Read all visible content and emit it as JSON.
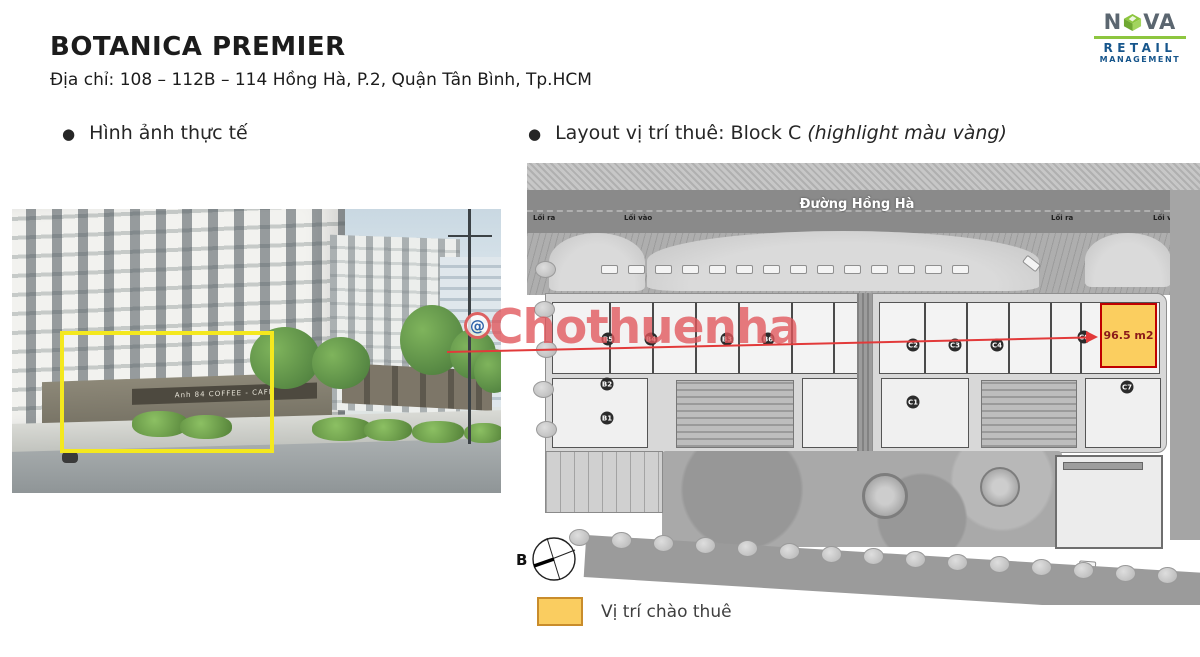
{
  "header": {
    "title": "BOTANICA PREMIER",
    "address": "Địa chỉ: 108 – 112B – 114 Hồng Hà, P.2, Quận Tân Bình, Tp.HCM"
  },
  "logo": {
    "name_left": "N",
    "name_right": "VA",
    "line1": "RETAIL",
    "line2": "MANAGEMENT",
    "green": "#8DC63F",
    "blue": "#17568C"
  },
  "sections": {
    "photo_heading": "Hình ảnh thực tế",
    "layout_heading": "Layout vị trí thuê: Block C ",
    "layout_heading_italic": "(highlight màu vàng)"
  },
  "photo": {
    "sign_text": "Anh 84 COFFEE - CAFE",
    "highlight_color": "#F4E81E"
  },
  "watermark": {
    "text": "Chothuenha",
    "icon": "@",
    "color": "#E0555A"
  },
  "plan": {
    "street_name": "Đường Hồng Hà",
    "road_labels": [
      {
        "text": "Lối ra",
        "x": 6
      },
      {
        "text": "Lối vào",
        "x": 97
      },
      {
        "text": "Lối ra",
        "x": 524
      },
      {
        "text": "Lối vào",
        "x": 626
      }
    ],
    "units": [
      {
        "label": "B5",
        "x": 81,
        "y": 176
      },
      {
        "label": "B4",
        "x": 124,
        "y": 176
      },
      {
        "label": "B3",
        "x": 200,
        "y": 176
      },
      {
        "label": "B6",
        "x": 241,
        "y": 176
      },
      {
        "label": "B2",
        "x": 80,
        "y": 221
      },
      {
        "label": "B1",
        "x": 80,
        "y": 255
      },
      {
        "label": "C2",
        "x": 386,
        "y": 182
      },
      {
        "label": "C3",
        "x": 428,
        "y": 182
      },
      {
        "label": "C4",
        "x": 470,
        "y": 182
      },
      {
        "label": "C1",
        "x": 386,
        "y": 239
      },
      {
        "label": "C6",
        "x": 557,
        "y": 174
      },
      {
        "label": "C7",
        "x": 600,
        "y": 224
      },
      {
        "label": "C8",
        "x": 571,
        "y": 348
      }
    ],
    "highlight_unit": {
      "area_label": "96.5 m2",
      "x": 573,
      "y": 140,
      "w": 57,
      "h": 65
    },
    "compass_label": "B"
  },
  "legend": {
    "label": "Vị trí chào thuê",
    "swatch_color": "#FACD60"
  }
}
